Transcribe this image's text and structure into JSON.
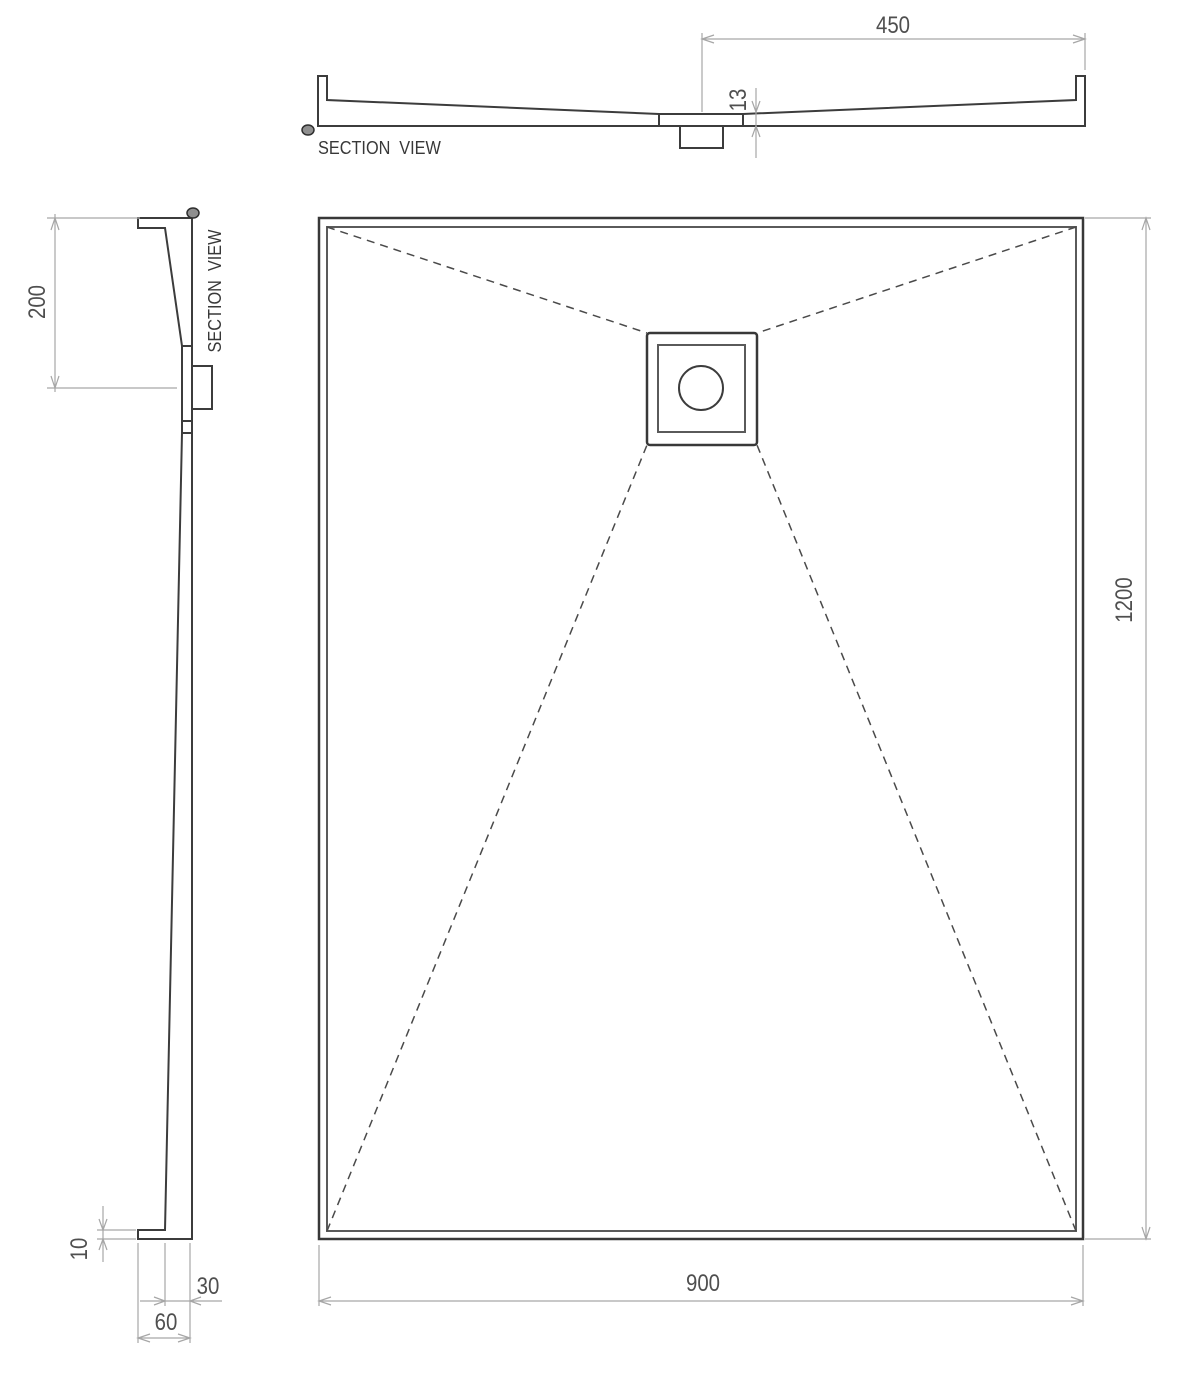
{
  "drawing": {
    "background": "#ffffff",
    "colors": {
      "geometry_line": "#3c3c3c",
      "secondary_line": "#5a5a5a",
      "dashed_slope_line": "#4a4a4a",
      "dimension_line": "#a6a6a6",
      "dimension_text": "#4f4f4f",
      "title_text": "#383838",
      "marker_fill": "#8f8f8f"
    },
    "top_section": {
      "title": "SECTION VIEW",
      "marker_icon": "section-cut-marker",
      "dim_width_to_drain": "450",
      "dim_recess_depth": "13"
    },
    "side_section": {
      "title": "SECTION VIEW",
      "marker_icon": "section-cut-marker",
      "dim_top_to_drain": "200",
      "dim_flange_height": "10",
      "dim_edge_depth": "30",
      "dim_edge_width": "60"
    },
    "plan": {
      "dim_width": "900",
      "dim_length": "1200"
    }
  }
}
